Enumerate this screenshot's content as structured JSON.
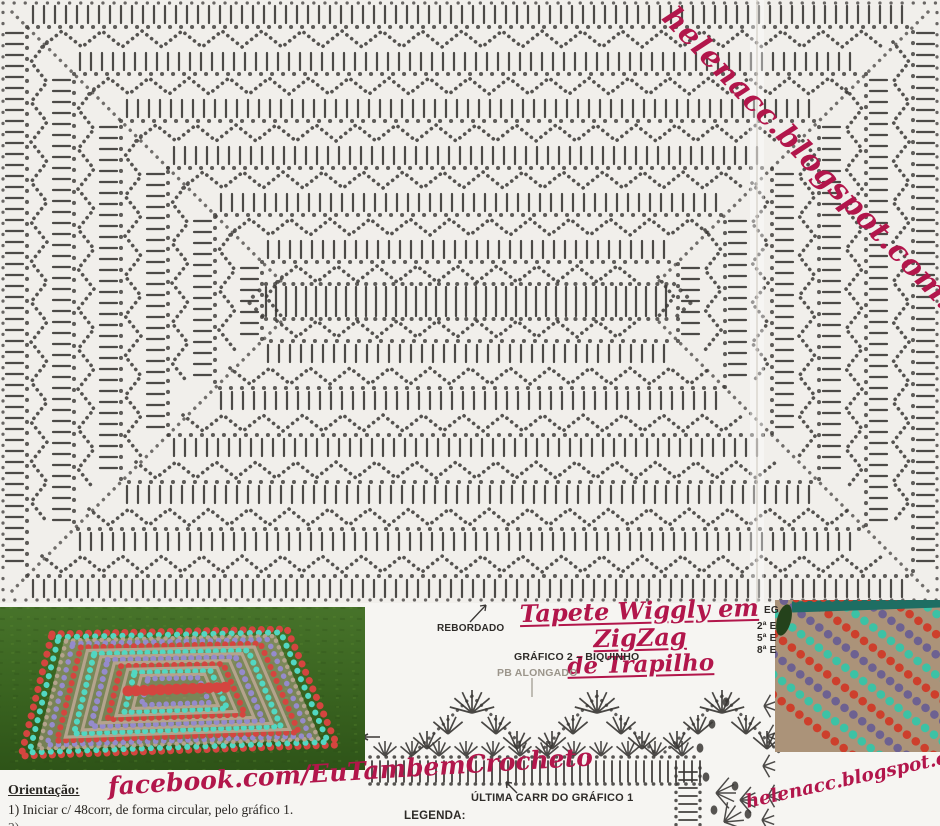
{
  "watermarks": {
    "blog_top": "helenacc.blogspot.com.br",
    "blog_bottom": "helenacc.blogspot.com.br",
    "facebook": "facebook.com/EuTambemCrocheto"
  },
  "title": {
    "line1": "Tapete Wiggly em ZigZag",
    "line2": "de Trapilho"
  },
  "labels": {
    "rebordado": "REBORDADO",
    "grafico2": "GRÁFICO 2 – BIQUINHO",
    "pb_alongado": "PB ALONGADO",
    "ultima_carr": "ÚLTIMA CARR DO GRÁFICO 1",
    "legenda": "LEGENDA:",
    "side_labels": [
      "EG",
      "2ª E",
      "5ª E",
      "8ª E"
    ]
  },
  "orientation": {
    "heading": "Orientação:",
    "step1": "1) Iniciar c/ 48corr, de forma circular, pelo gráfico 1.",
    "step2_partial": "2) ........ .. ...... ........ ... ........ . . ."
  },
  "colors": {
    "accent": "#b2164b",
    "ink": "#3a3735",
    "paper": "#f1efeb",
    "page_bg": "#f6f5f2",
    "label_gray": "#9b958b",
    "grass_dark": "#2e5418",
    "grass_light": "#47732a",
    "rug_red": "#d4453f",
    "rug_teal": "#52d7c2",
    "rug_lilac": "#958bcc",
    "rug_tan": "#b4a38d",
    "photo2_tan": "#ab9379",
    "photo2_red": "#cd3f2c",
    "photo2_teal": "#3cc2a5",
    "photo2_purple": "#6d6191",
    "photo2_darkteal": "#1e6e63"
  }
}
